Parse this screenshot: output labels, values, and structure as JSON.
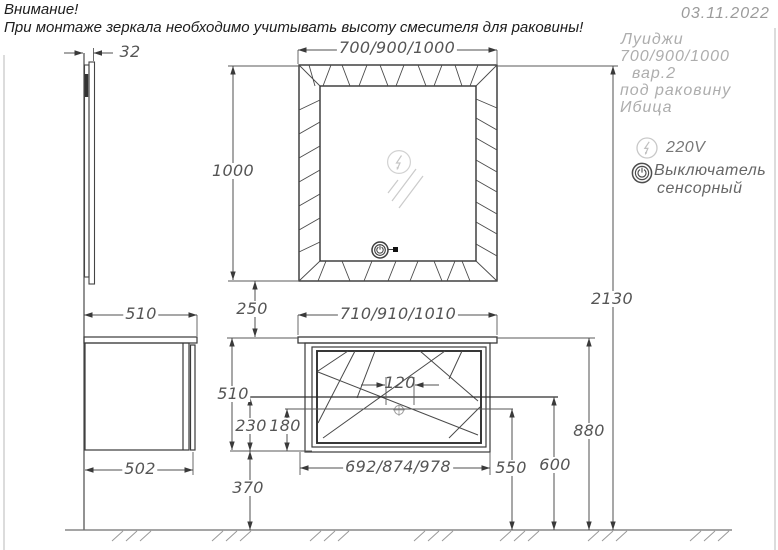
{
  "meta": {
    "date": "03.11.2022"
  },
  "warning": {
    "line1": "Внимание!",
    "line2": "При монтаже зеркала необходимо учитывать высоту смесителя для раковины!"
  },
  "notes": {
    "line1": "Луиджи",
    "line2": "700/900/1000",
    "line3": "вар.2",
    "line4": "под  раковину",
    "line5": "Ибица"
  },
  "legend": {
    "voltage": "220V",
    "switch_line1": "Выключатель",
    "switch_line2": "сенсорный"
  },
  "dimensions": {
    "mirror_thickness": "32",
    "mirror_width": "700/900/1000",
    "mirror_height": "1000",
    "gap_mirror_cabinet": "250",
    "cabinet_depth": "510",
    "cabinet_body_depth": "502",
    "cabinet_top_width": "710/910/1010",
    "cabinet_height": "510",
    "faucet_hole_spacing": "120",
    "drain_to_bottom": "230",
    "lower_line_to_bottom": "180",
    "bottom_to_floor": "370",
    "cabinet_body_width": "692/874/978",
    "height_550": "550",
    "height_600": "600",
    "height_880": "880",
    "total_height": "2130"
  },
  "icons": {
    "voltage": "lightning-in-circle",
    "touch_switch": "power-in-circle",
    "mirror_lamp": "lightning-in-circle",
    "mirror_touch_switch": "power-in-circle"
  },
  "colors": {
    "line_dark": "#3a3a3a",
    "dim_line": "#4f4f4f",
    "dim_text": "#555555",
    "note_text": "#adadad",
    "light_icon": "#c8c8c8",
    "background": "#ffffff"
  }
}
